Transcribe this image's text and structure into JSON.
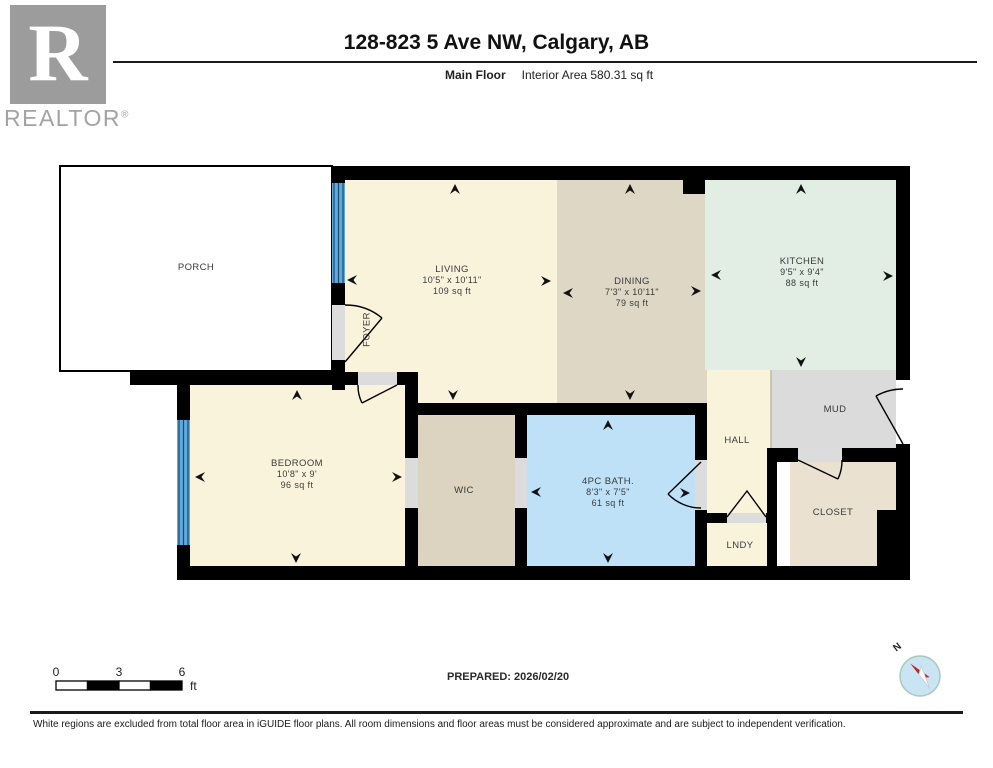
{
  "header": {
    "title": "128-823 5 Ave NW, Calgary, AB",
    "floor_label": "Main Floor",
    "area_label": "Interior Area 580.31 sq ft"
  },
  "brand": {
    "logo_letter": "R",
    "wordmark": "REALTOR",
    "reg": "®"
  },
  "rooms": {
    "porch": {
      "name": "PORCH"
    },
    "living": {
      "name": "LIVING",
      "dims": "10'5\" x 10'11\"",
      "area": "109 sq ft"
    },
    "foyer": {
      "name": "FOYER"
    },
    "dining": {
      "name": "DINING",
      "dims": "7'3\" x 10'11\"",
      "area": "79 sq ft"
    },
    "kitchen": {
      "name": "KITCHEN",
      "dims": "9'5\" x 9'4\"",
      "area": "88 sq ft"
    },
    "mud": {
      "name": "MUD"
    },
    "hall": {
      "name": "HALL"
    },
    "bedroom": {
      "name": "BEDROOM",
      "dims": "10'8\" x 9'",
      "area": "96 sq ft"
    },
    "wic": {
      "name": "WIC"
    },
    "bath": {
      "name": "4PC BATH.",
      "dims": "8'3\" x 7'5\"",
      "area": "61 sq ft"
    },
    "lndy": {
      "name": "LNDY"
    },
    "closet": {
      "name": "CLOSET"
    }
  },
  "scale_bar": {
    "ticks": [
      "0",
      "3",
      "6"
    ],
    "unit": "ft"
  },
  "prepared": {
    "label": "PREPARED: 2026/02/20"
  },
  "compass": {
    "north_label": "N"
  },
  "footer": {
    "disclaimer": "White regions are excluded from total floor area in iGUIDE floor plans. All room dimensions and floor areas must be considered approximate and are subject to independent verification."
  },
  "colors": {
    "wall": "#000000",
    "porch": "#ffffff",
    "living": "#faf3dc",
    "dining": "#dfd7c5",
    "kitchen": "#e2ede3",
    "hall": "#faf3dc",
    "mud": "#dbdbdb",
    "lndy": "#faf3dc",
    "closet": "#eae1d1",
    "bedroom": "#faf3dc",
    "wic": "#dcd4c1",
    "bath": "#bee1f8",
    "window": "#5fa9dc",
    "window_frame": "#1c4a6e",
    "door_opening": "#dcdcdc",
    "compass_fill": "#c9e4f3",
    "compass_ring": "#a9c9b9",
    "compass_red": "#c42127"
  }
}
